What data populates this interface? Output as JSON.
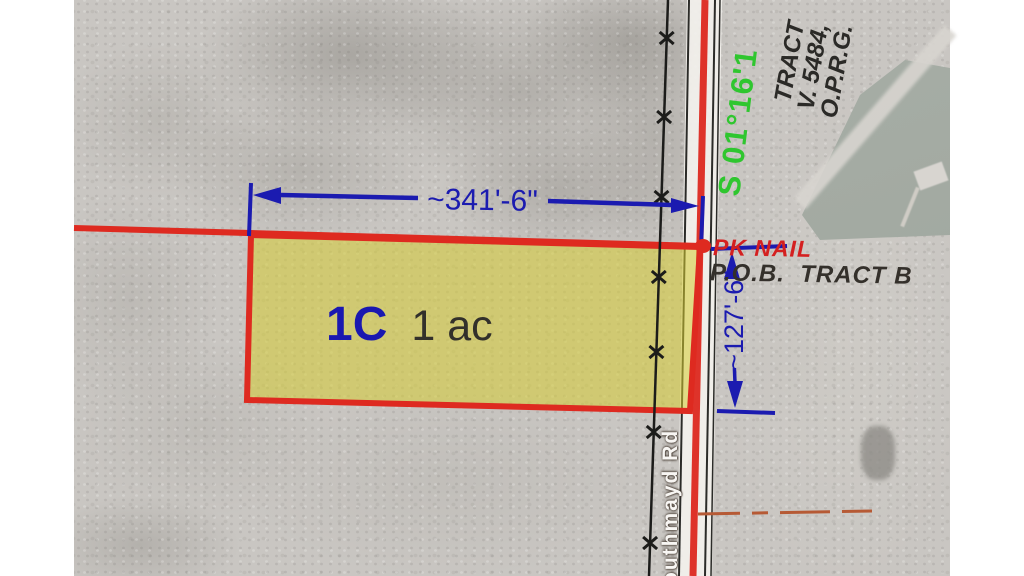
{
  "parcel": {
    "id": "1C",
    "area": "1 ac"
  },
  "dimensions": {
    "frontage": "~341'-6\"",
    "depth": "~127'-6\""
  },
  "markers": {
    "nail_label": "PK NAIL",
    "pob_label": "P.O.B.  TRACT B"
  },
  "bearing_label": "S 01°16'1",
  "record_text": {
    "line1": "TRACT",
    "line2": "V. 5484,",
    "line3": "O.P.R.G."
  },
  "road": {
    "name": "Southmayd Rd"
  },
  "colors": {
    "boundary_red": "#de2a20",
    "dimension_blue": "#1b1bb0",
    "bearing_green": "#2fc62f",
    "parcel_yellow": "#d6cc3c",
    "nail_red": "#d42020",
    "dark_text": "#34302b",
    "easement_dash": "#b65a35"
  }
}
